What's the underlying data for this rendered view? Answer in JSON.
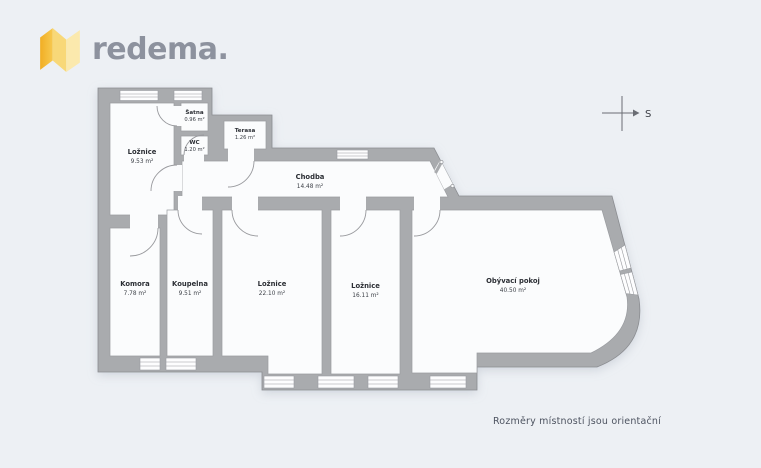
{
  "logo": {
    "text": "redema.",
    "icon": "folded-map-icon",
    "accent_color": "#F2B52C",
    "text_color": "#8D929E"
  },
  "compass": {
    "label": "S"
  },
  "floorplan": {
    "rooms": [
      {
        "name": "Ložnice",
        "area": "9.53 m²"
      },
      {
        "name": "Šatna",
        "area": "0.96 m²"
      },
      {
        "name": "WC",
        "area": "1.20 m²"
      },
      {
        "name": "Terasa",
        "area": "1.26 m²"
      },
      {
        "name": "Chodba",
        "area": "14.48 m²"
      },
      {
        "name": "Komora",
        "area": "7.78 m²"
      },
      {
        "name": "Koupelna",
        "area": "9.51 m²"
      },
      {
        "name": "Ložnice",
        "area": "22.10 m²"
      },
      {
        "name": "Ložnice",
        "area": "16.11 m²"
      },
      {
        "name": "Obývací pokoj",
        "area": "40.50 m²"
      }
    ],
    "wall_color": "#A9ABAE",
    "room_color": "#FBFCFD",
    "background_color": "#EDF0F4"
  },
  "footer": {
    "note": "Rozměry místností jsou orientační"
  }
}
